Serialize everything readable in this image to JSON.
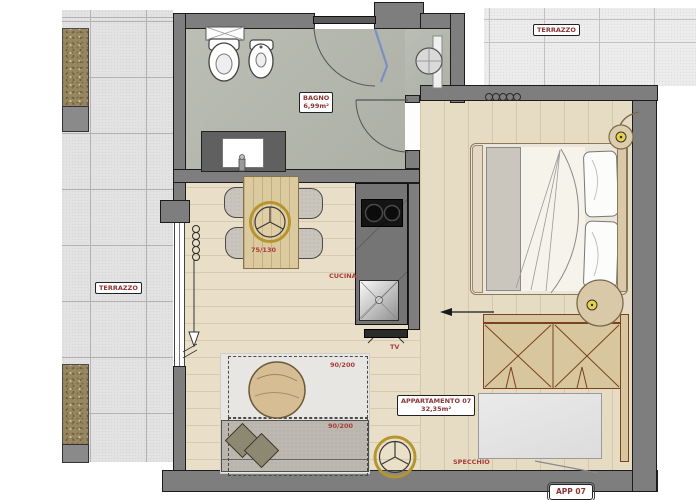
{
  "floorplan": {
    "labels": {
      "terrace_left": "TERRAZZO",
      "terrace_top": "TERRAZZO",
      "bathroom_name": "BAGNO",
      "bathroom_area": "6,99m²",
      "apartment_name": "APPARTAMENTO 07",
      "apartment_area": "32,35m²",
      "apartment_tag": "APP 07",
      "kitchen": "CUCINA",
      "tv": "TV",
      "dining_table_size": "75/130",
      "sofabed_top": "90/200",
      "sofabed_bottom": "90/200",
      "mirror": "SPECCHIO"
    },
    "colors": {
      "wall": "#7e7e7e",
      "bathroom_floor": "#b6b9ae",
      "wood_floor": "#e9dfc8",
      "terrace_tile": "#e2e2e2",
      "gravel": "#97865f",
      "label_red": "#8b3434",
      "annotation_red": "#a83c3c",
      "accent_yellow": "#b5952e",
      "glass_blue": "#7b8fc4",
      "wardrobe_brown": "#7a4222"
    },
    "icons": {
      "toilet": "oval-bowl",
      "bidet": "oval-bowl-small",
      "shower-basin": "circle-cross",
      "washbasin": "white-rect",
      "stove-burners": "two-black-circles",
      "kitchen-sink": "metal-square-x",
      "radiator": "coil-loops",
      "ceiling-lamp": "yellow-ring-three-spokes",
      "door-swing": "quarter-arc",
      "direction-arrow": "left-arrow"
    }
  }
}
